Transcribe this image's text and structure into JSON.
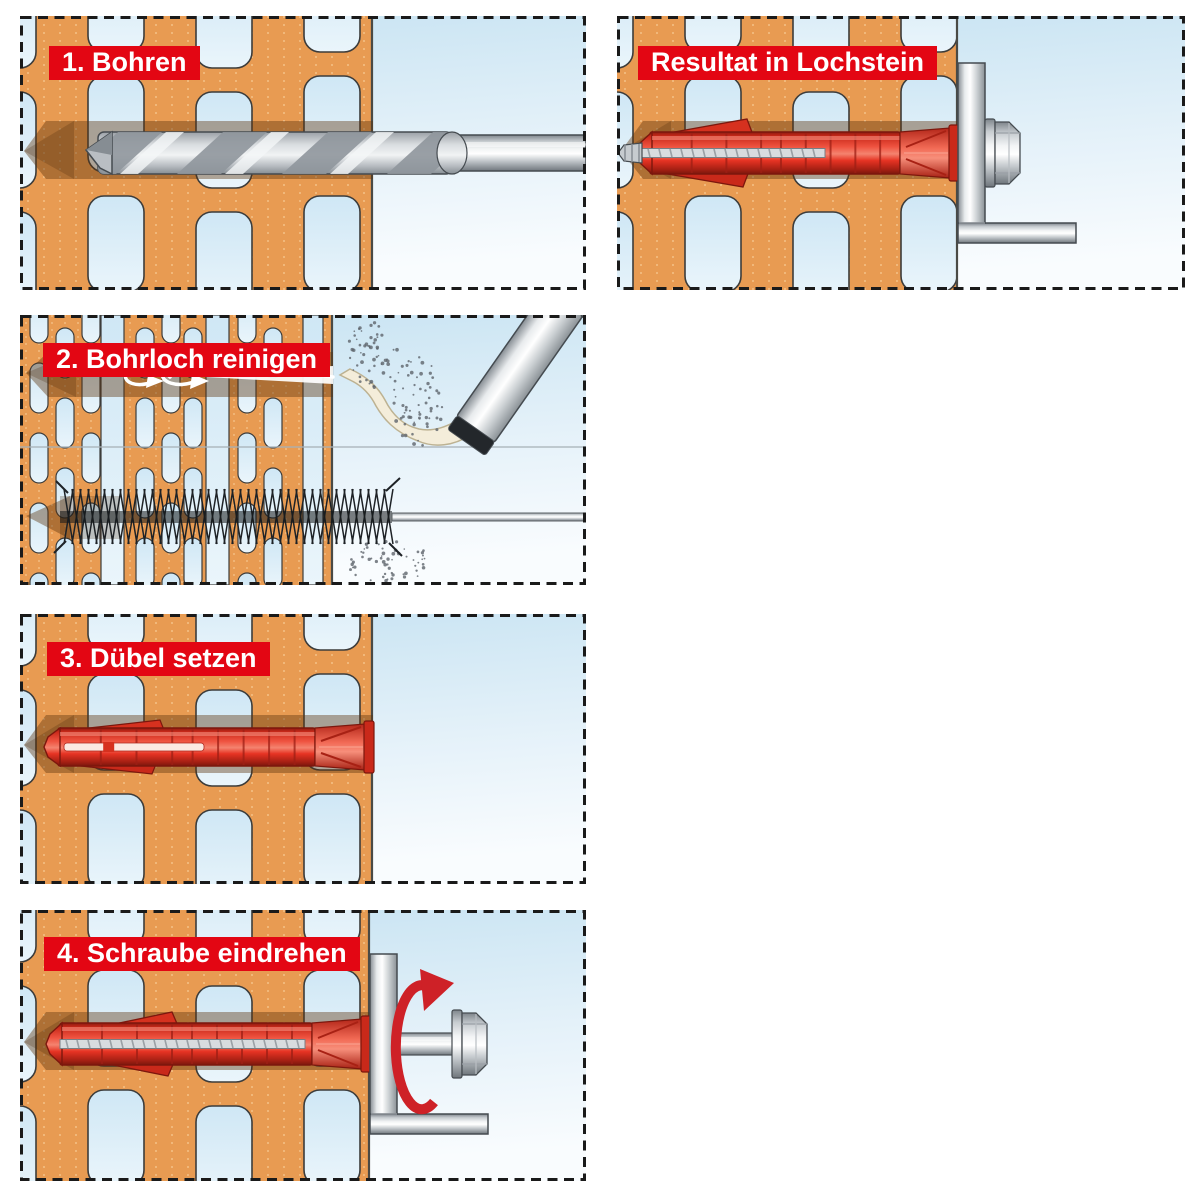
{
  "page": {
    "background": "#FFFFFF"
  },
  "panels": [
    {
      "id": "step-1",
      "title": "1. Bohren",
      "illustration": "drill-bit-in-perforated-brick"
    },
    {
      "id": "result",
      "title": "Resultat in Lochstein",
      "illustration": "expanded-anchor-with-screw-and-angle-bracket"
    },
    {
      "id": "step-2",
      "title": "2. Bohrloch reinigen",
      "illustration": "blow-out-pump-and-cleaning-brush"
    },
    {
      "id": "step-3",
      "title": "3. Dübel setzen",
      "illustration": "plastic-anchor-inserted-flush"
    },
    {
      "id": "step-4",
      "title": "4. Schraube eindrehen",
      "illustration": "screw-driven-in-with-rotation-arrow"
    }
  ],
  "colors": {
    "label_bg": "#E30613",
    "label_text": "#FFFFFF",
    "panel_border": "#1A1A1A",
    "brick": "#E89B52",
    "brick_texture": "#F7C992",
    "outline": "#3C3C3B",
    "hole_top": "#CFE7F5",
    "hole_bottom": "#EAF5FB",
    "bg_top": "#C7E3F2",
    "bg_mid": "#E4F1F9",
    "bg_bottom": "#F9FCFE",
    "channel_shadow": "rgba(92,52,15,0.42)",
    "channel_shadow_deep": "rgba(70,38,10,0.24)",
    "anchor_red": "#E63323",
    "anchor_red_dark": "#8E1B10",
    "anchor_red_bright": "#F4836F",
    "arrow_red": "#CE2127",
    "metal_outline": "#454B50",
    "air_stream": "#F4EDDA",
    "air_stream_outline": "#BDB292",
    "dust": "#5E646B",
    "brush_black": "#1E2226",
    "separator_line": "#A7B2B8",
    "swirl_white": "#FFFFFF"
  }
}
